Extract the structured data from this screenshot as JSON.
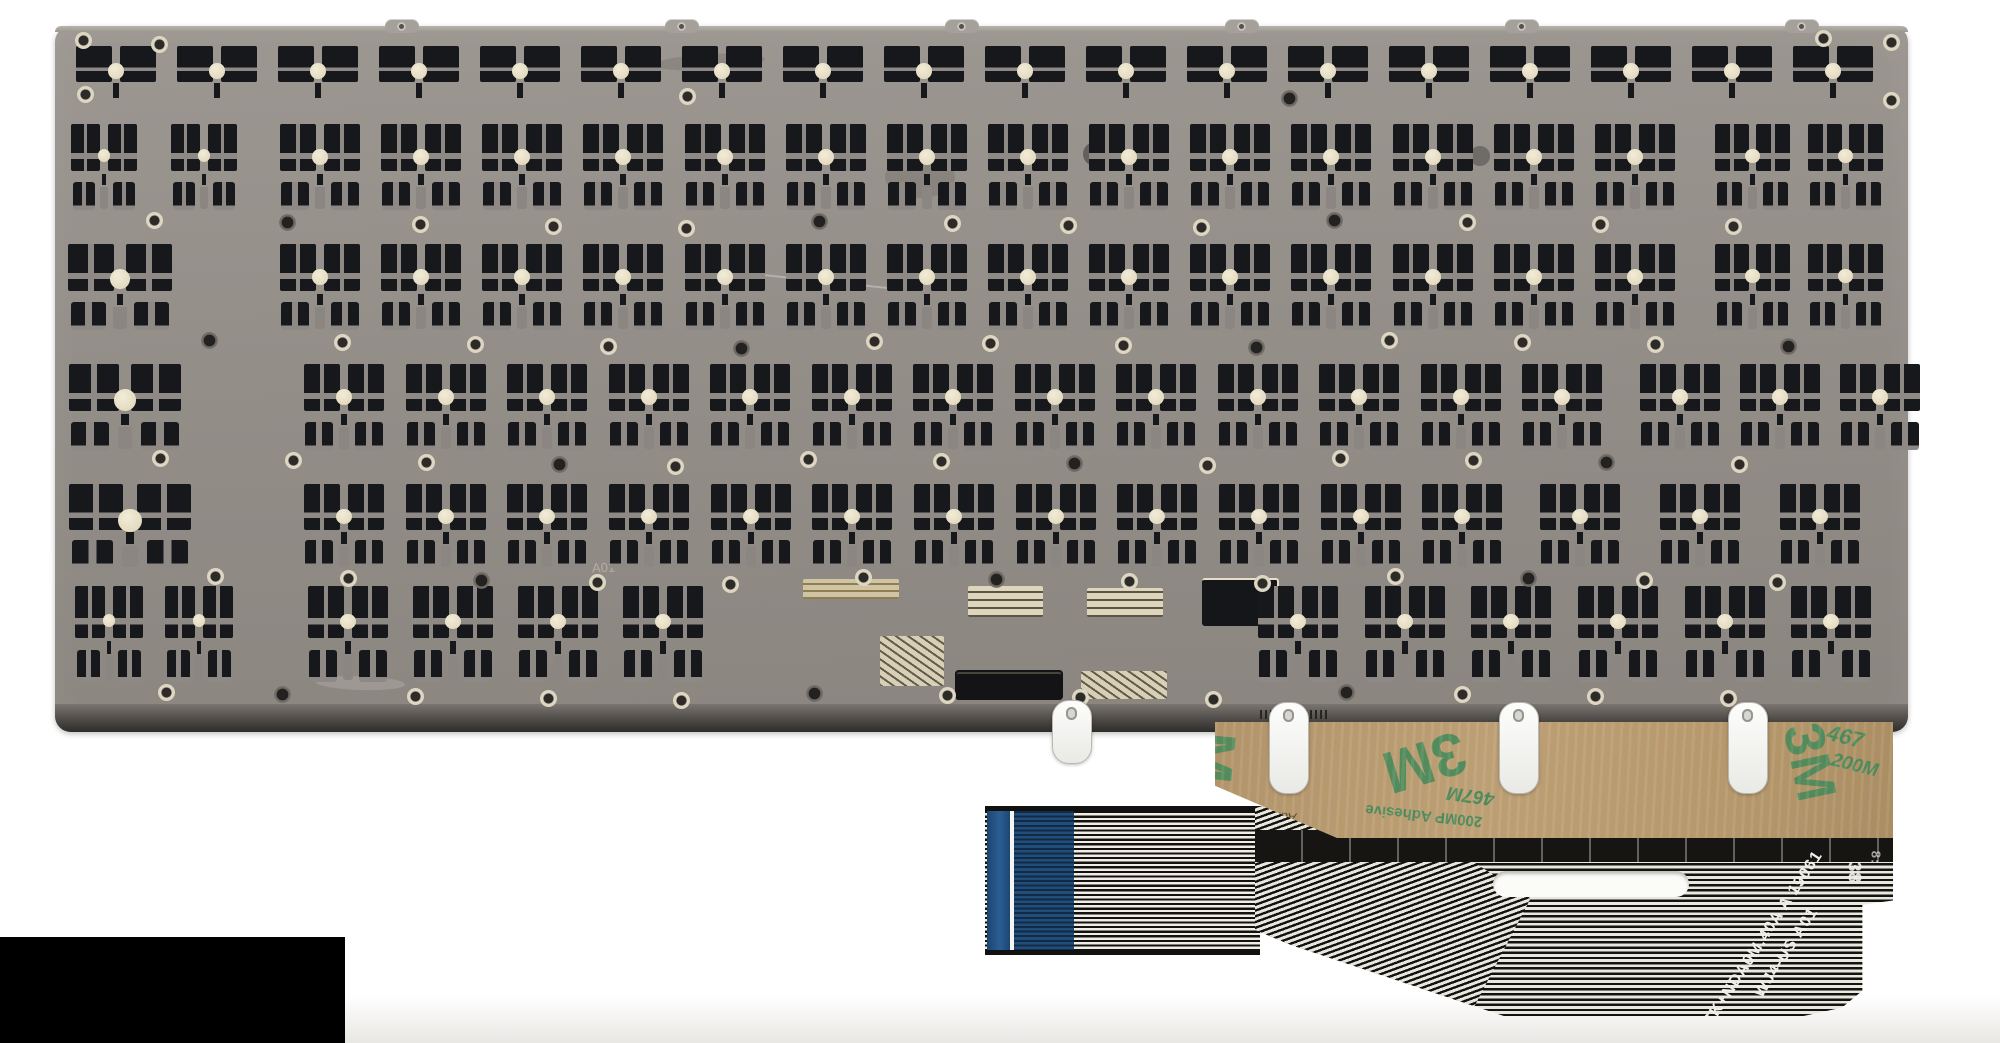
{
  "plate": {
    "marking": "A01"
  },
  "tape": {
    "brand": "3M",
    "brand_partial": "M",
    "code_top": "467",
    "code_bottom": "200M",
    "product_small": "467M",
    "adhesive_small": "200MP Adhesive",
    "liner_word": "Adhesive"
  },
  "cable": {
    "line1": "6K+NDA0M.40A A 19061",
    "line2": "WJ4-US A01",
    "stamp": "38",
    "stamp2": "8:"
  },
  "colors": {
    "plate_base": "#948e89",
    "module_black": "#17181b",
    "membrane_cream": "#e9e1c9",
    "tape_tan": "#b6986c",
    "tape_green": "#4b8a5b",
    "cable_black": "#131310",
    "cable_white": "#eae7df",
    "connector_blue": "#2a5e93",
    "background": "#ffffff"
  }
}
